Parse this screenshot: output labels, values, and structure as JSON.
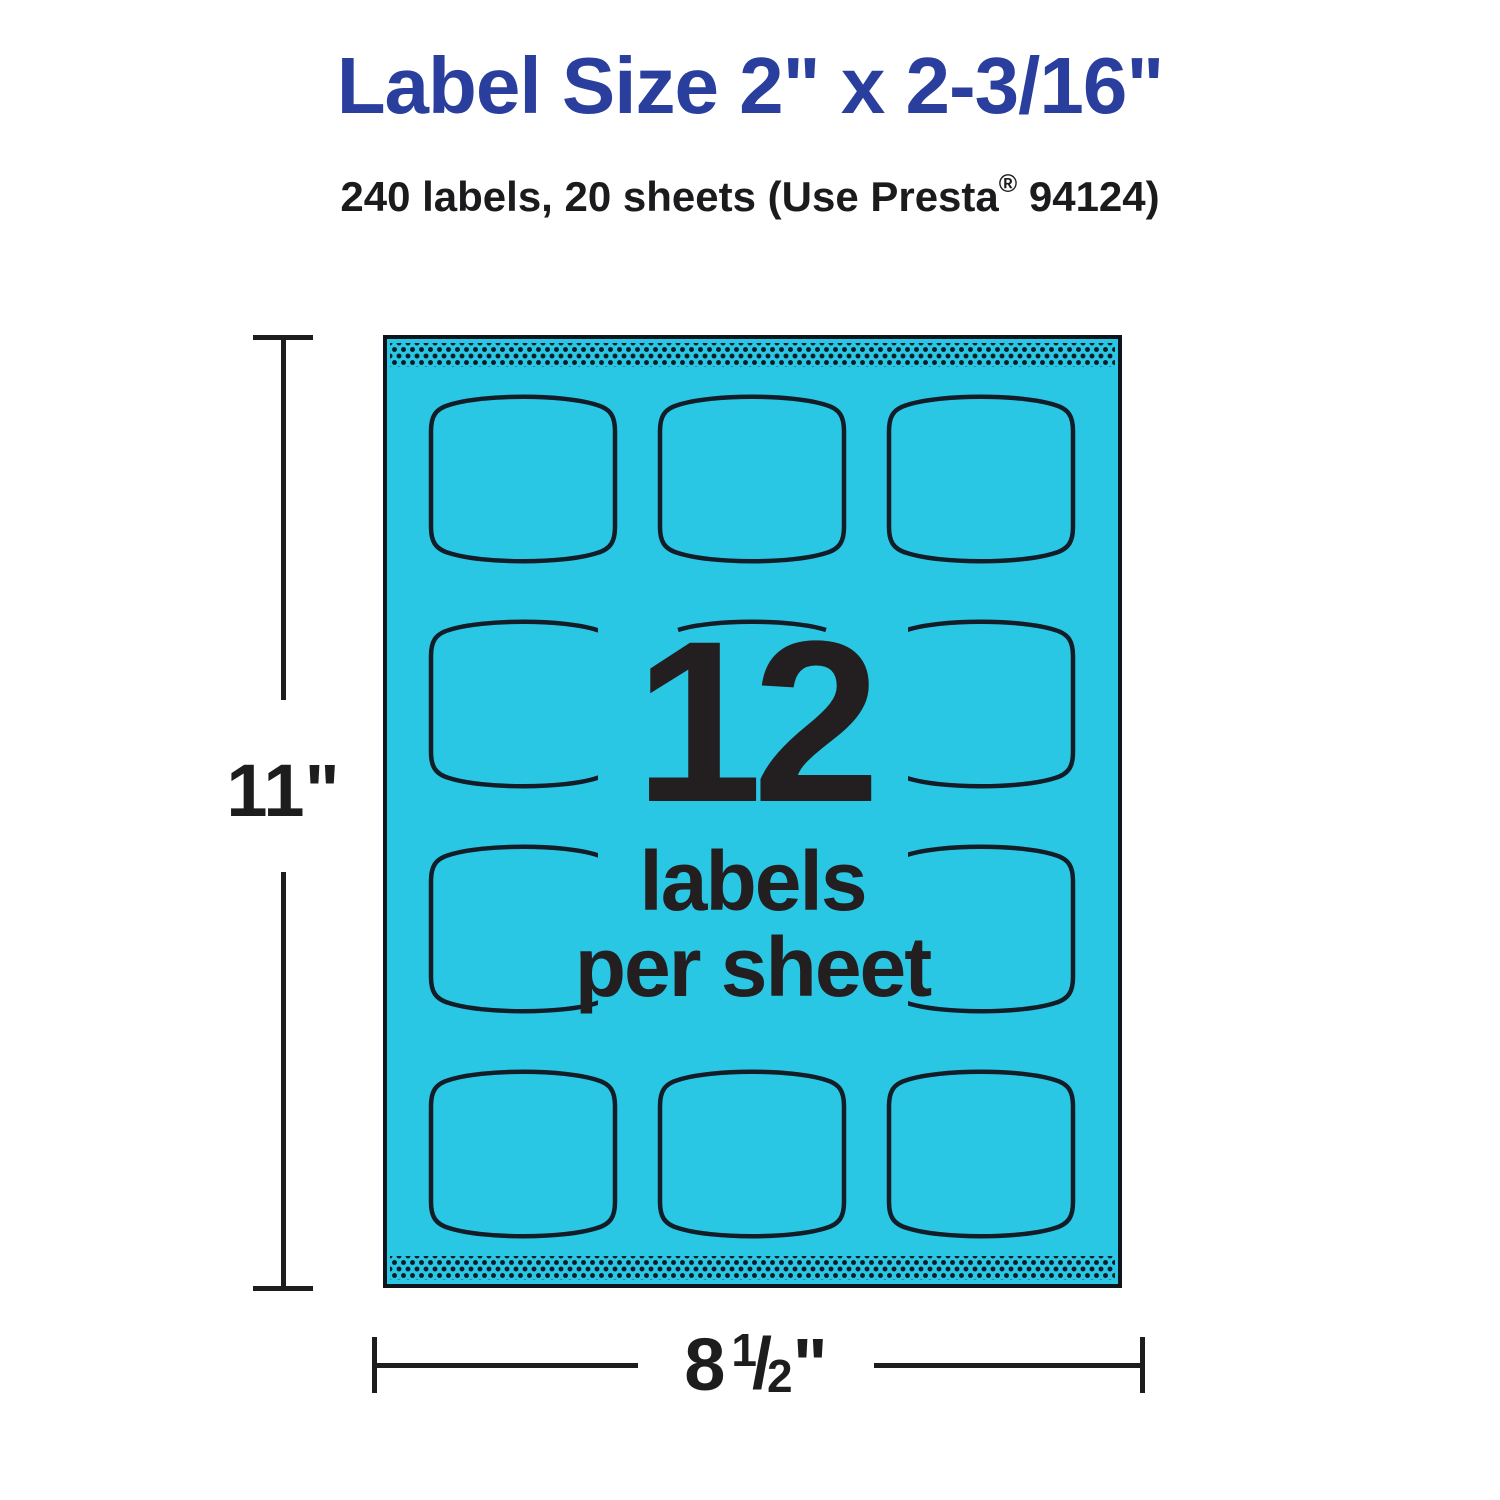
{
  "header": {
    "title": "Label Size 2\" x 2-3/16\"",
    "subtitle_pre": "240 labels, 20 sheets (Use Presta",
    "subtitle_reg": "®",
    "subtitle_post": " 94124)"
  },
  "sheet": {
    "count_number": "12",
    "count_caption_line1": "labels",
    "count_caption_line2": "per sheet",
    "labels_per_sheet": 12,
    "grid_columns": 3,
    "grid_rows": 4,
    "paper_color": "#2AC7E4",
    "outline_color": "#131D28",
    "perforation_dot_color": "#0F1B26"
  },
  "dimensions": {
    "height": "11\"",
    "width_whole": "8",
    "width_numerator": "1",
    "width_slash": "/",
    "width_denominator": "2",
    "width_unit": "\""
  },
  "colors": {
    "title_blue": "#2A3F9D",
    "ink_dark": "#231F20"
  }
}
